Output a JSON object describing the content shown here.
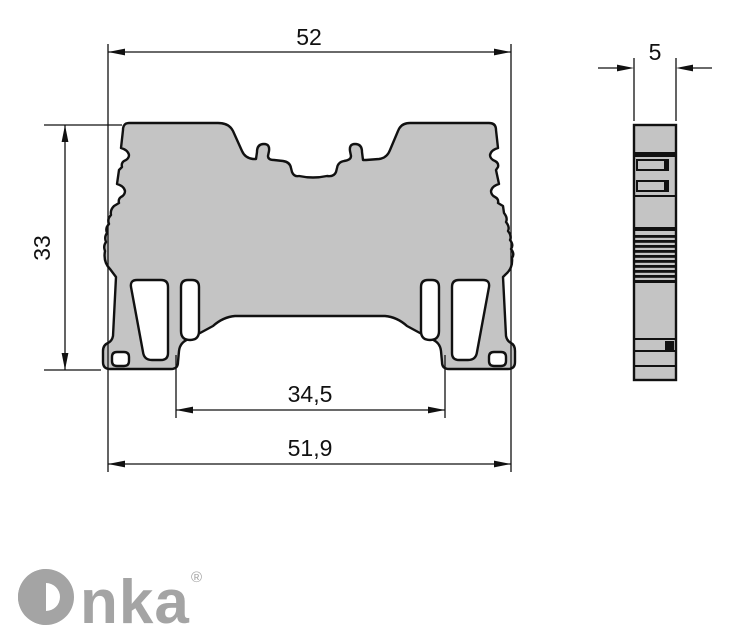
{
  "drawing": {
    "title": "DIN rail terminal block dimensional drawing",
    "front_view": {
      "dim_width_top": "52",
      "dim_height": "33",
      "dim_rail_slot": "34,5",
      "dim_width_bottom": "51,9"
    },
    "side_view": {
      "dim_thickness": "5"
    },
    "colors": {
      "body_fill": "#c4c4c4",
      "outline": "#111111",
      "dimension_line": "#111111",
      "logo_gray": "#a4a4a4",
      "background": "#ffffff"
    }
  },
  "branding": {
    "logo_text": "Onka",
    "logo_letters_after_mark": "nka",
    "registered_mark": "®"
  }
}
